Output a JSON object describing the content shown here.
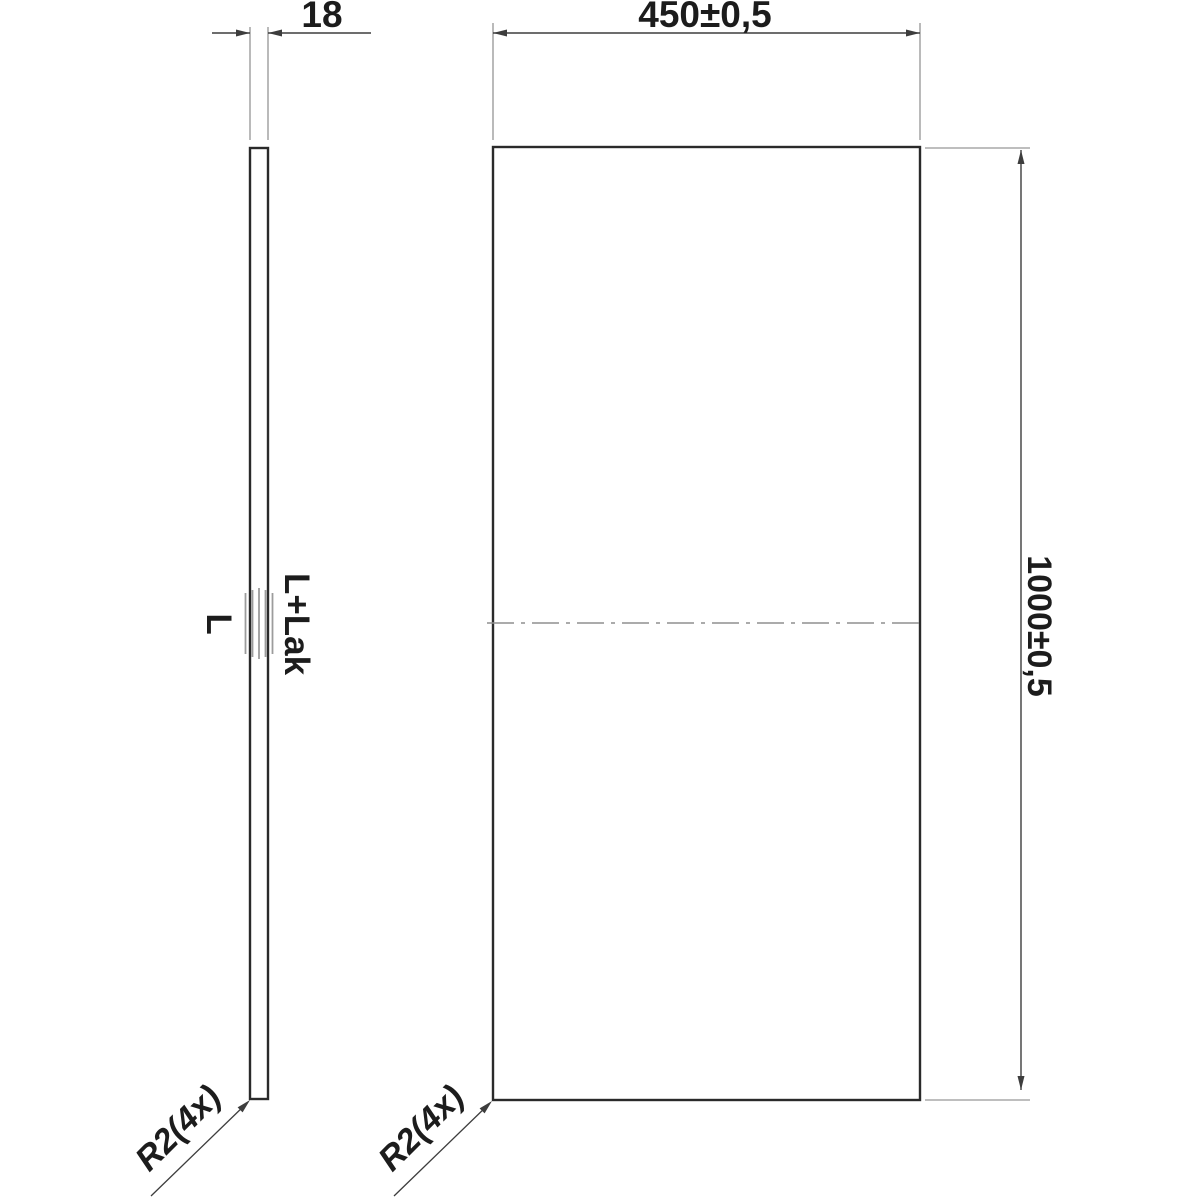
{
  "colors": {
    "background": "#ffffff",
    "object_line": "#2a2a2a",
    "dimension_line": "#3d3d3d",
    "extension_line": "#a8a8a8",
    "centerline": "#8f8f8f",
    "finish_mark": "#9c9c9c",
    "text": "#1c1c1c"
  },
  "side_view": {
    "thickness_dimension": "18",
    "surface_label_left": "L",
    "surface_label_right": "L+Lak",
    "radius_callout": "R2(4x)"
  },
  "front_view": {
    "width_dimension": "450±0,5",
    "height_dimension": "1000±0,5",
    "radius_callout": "R2(4x)"
  }
}
